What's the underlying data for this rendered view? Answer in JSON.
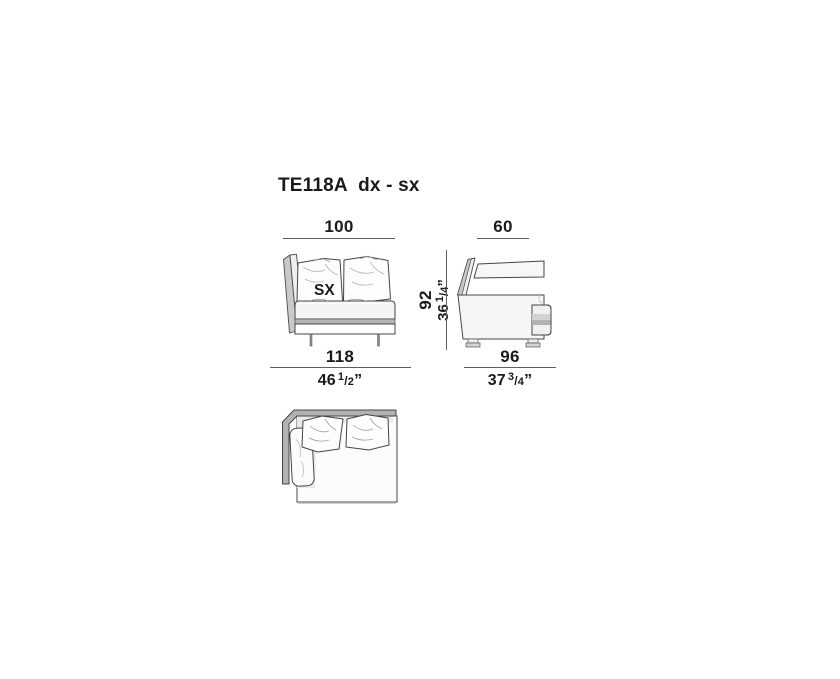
{
  "title": "TE118A  dx - sx",
  "orientation_label": "SX",
  "dims": {
    "front_width_cm": "100",
    "side_depth_cm": "60",
    "height": {
      "cm": "92",
      "in_whole": "36",
      "in_num": "1",
      "in_den": "4",
      "in_unit": "”"
    },
    "total_width": {
      "cm": "118",
      "in_whole": "46",
      "in_num": "1",
      "in_den": "2",
      "in_unit": "”"
    },
    "total_depth": {
      "cm": "96",
      "in_whole": "37",
      "in_num": "3",
      "in_den": "4",
      "in_unit": "”"
    }
  },
  "colors": {
    "text": "#1a1a1a",
    "line": "#5f5f5f",
    "outline": "#454545",
    "gray_band": "#b2b2b2",
    "mid_gray": "#c9c9c9",
    "light_gray": "#e9e9e9",
    "fill_white": "#fbfbfb"
  }
}
